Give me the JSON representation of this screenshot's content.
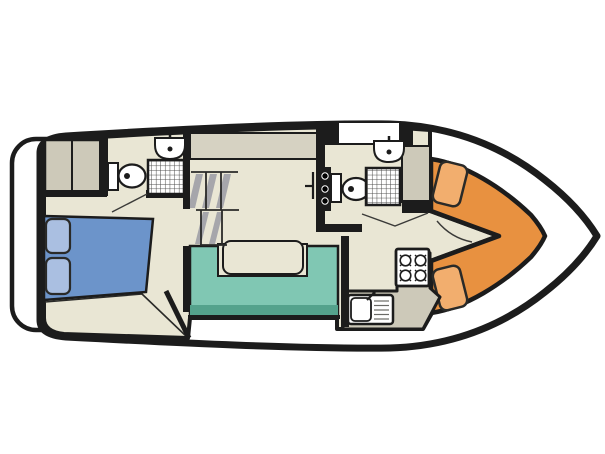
{
  "meta": {
    "description": "Top-down floor plan diagram of a motor cruiser canal boat",
    "diagram_type": "boat-floorplan"
  },
  "colors": {
    "background": "#ffffff",
    "outline": "#1c1c1c",
    "hull_white": "#ffffff",
    "floor_beige": "#e9e6d4",
    "sideboard_gray": "#d6d2c2",
    "cabinet_gray": "#cdc9b9",
    "bed_blue": "#6c94ca",
    "pillow_blue": "#aabfe1",
    "sofa_teal": "#80c7b3",
    "sofa_edge_teal": "#54a28c",
    "cockpit_orange": "#e89140",
    "seat_orange": "#f2ae6e",
    "stair_gray": "#a6a6ab",
    "fixture_white": "#ffffff"
  },
  "legend": {
    "areas": [
      "swim-platform",
      "hull-deck",
      "aft-cabin",
      "aft-bathroom",
      "wardrobe",
      "companionway-stairs",
      "saloon",
      "galley",
      "forward-bathroom",
      "bow-cockpit"
    ],
    "furniture": [
      "double-bed",
      "pillows",
      "u-shaped-sofa",
      "saloon-table",
      "cockpit-seats"
    ],
    "fixtures": [
      "toilet",
      "washbasin",
      "shower",
      "four-burner-stove",
      "kitchen-sink"
    ]
  }
}
